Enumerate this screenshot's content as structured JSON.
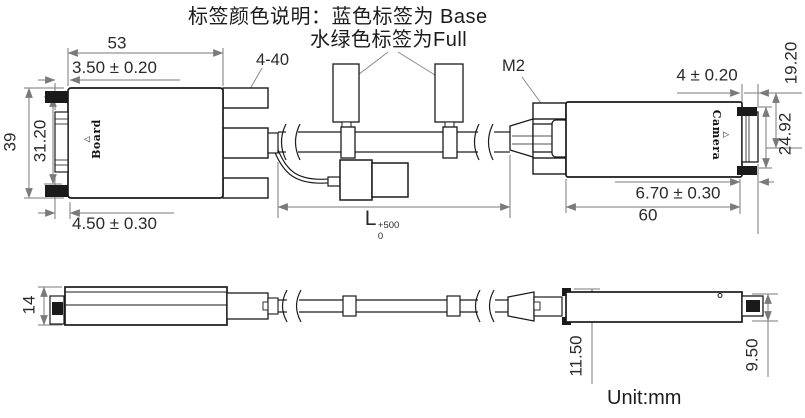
{
  "note": {
    "line1": "标签颜色说明：蓝色标签为 Base",
    "line2": "水绿色标签为Full"
  },
  "annotations": {
    "screw_left": "4-40",
    "screw_right": "M2"
  },
  "connector_labels": {
    "board": "Board",
    "camera": "Camera",
    "orientation_mark": "△"
  },
  "dimensions": {
    "top_view": {
      "board_body_width": "53",
      "board_shell_offset": "3.50 ± 0.20",
      "board_body_height": "39",
      "board_shell_height": "31.20",
      "board_screw_offset": "4.50 ± 0.30",
      "cable_length_symbol": "L",
      "cable_length_tol_upper": "+500",
      "cable_length_tol_lower": "0",
      "camera_shell_step": "4 ± 0.20",
      "camera_screw_span": "19.20",
      "camera_shell_height": "24.92",
      "camera_shell_offset": "6.70 ± 0.30",
      "camera_body_width": "60"
    },
    "side_view": {
      "board_body_thickness": "14",
      "camera_clamp_height": "11.50",
      "camera_shell_thickness": "9.50"
    }
  },
  "footer": {
    "unit": "Unit:mm"
  },
  "colors": {
    "object_line": "#1a1a1a",
    "dimension_line": "#7a7a7a",
    "background": "#ffffff"
  }
}
